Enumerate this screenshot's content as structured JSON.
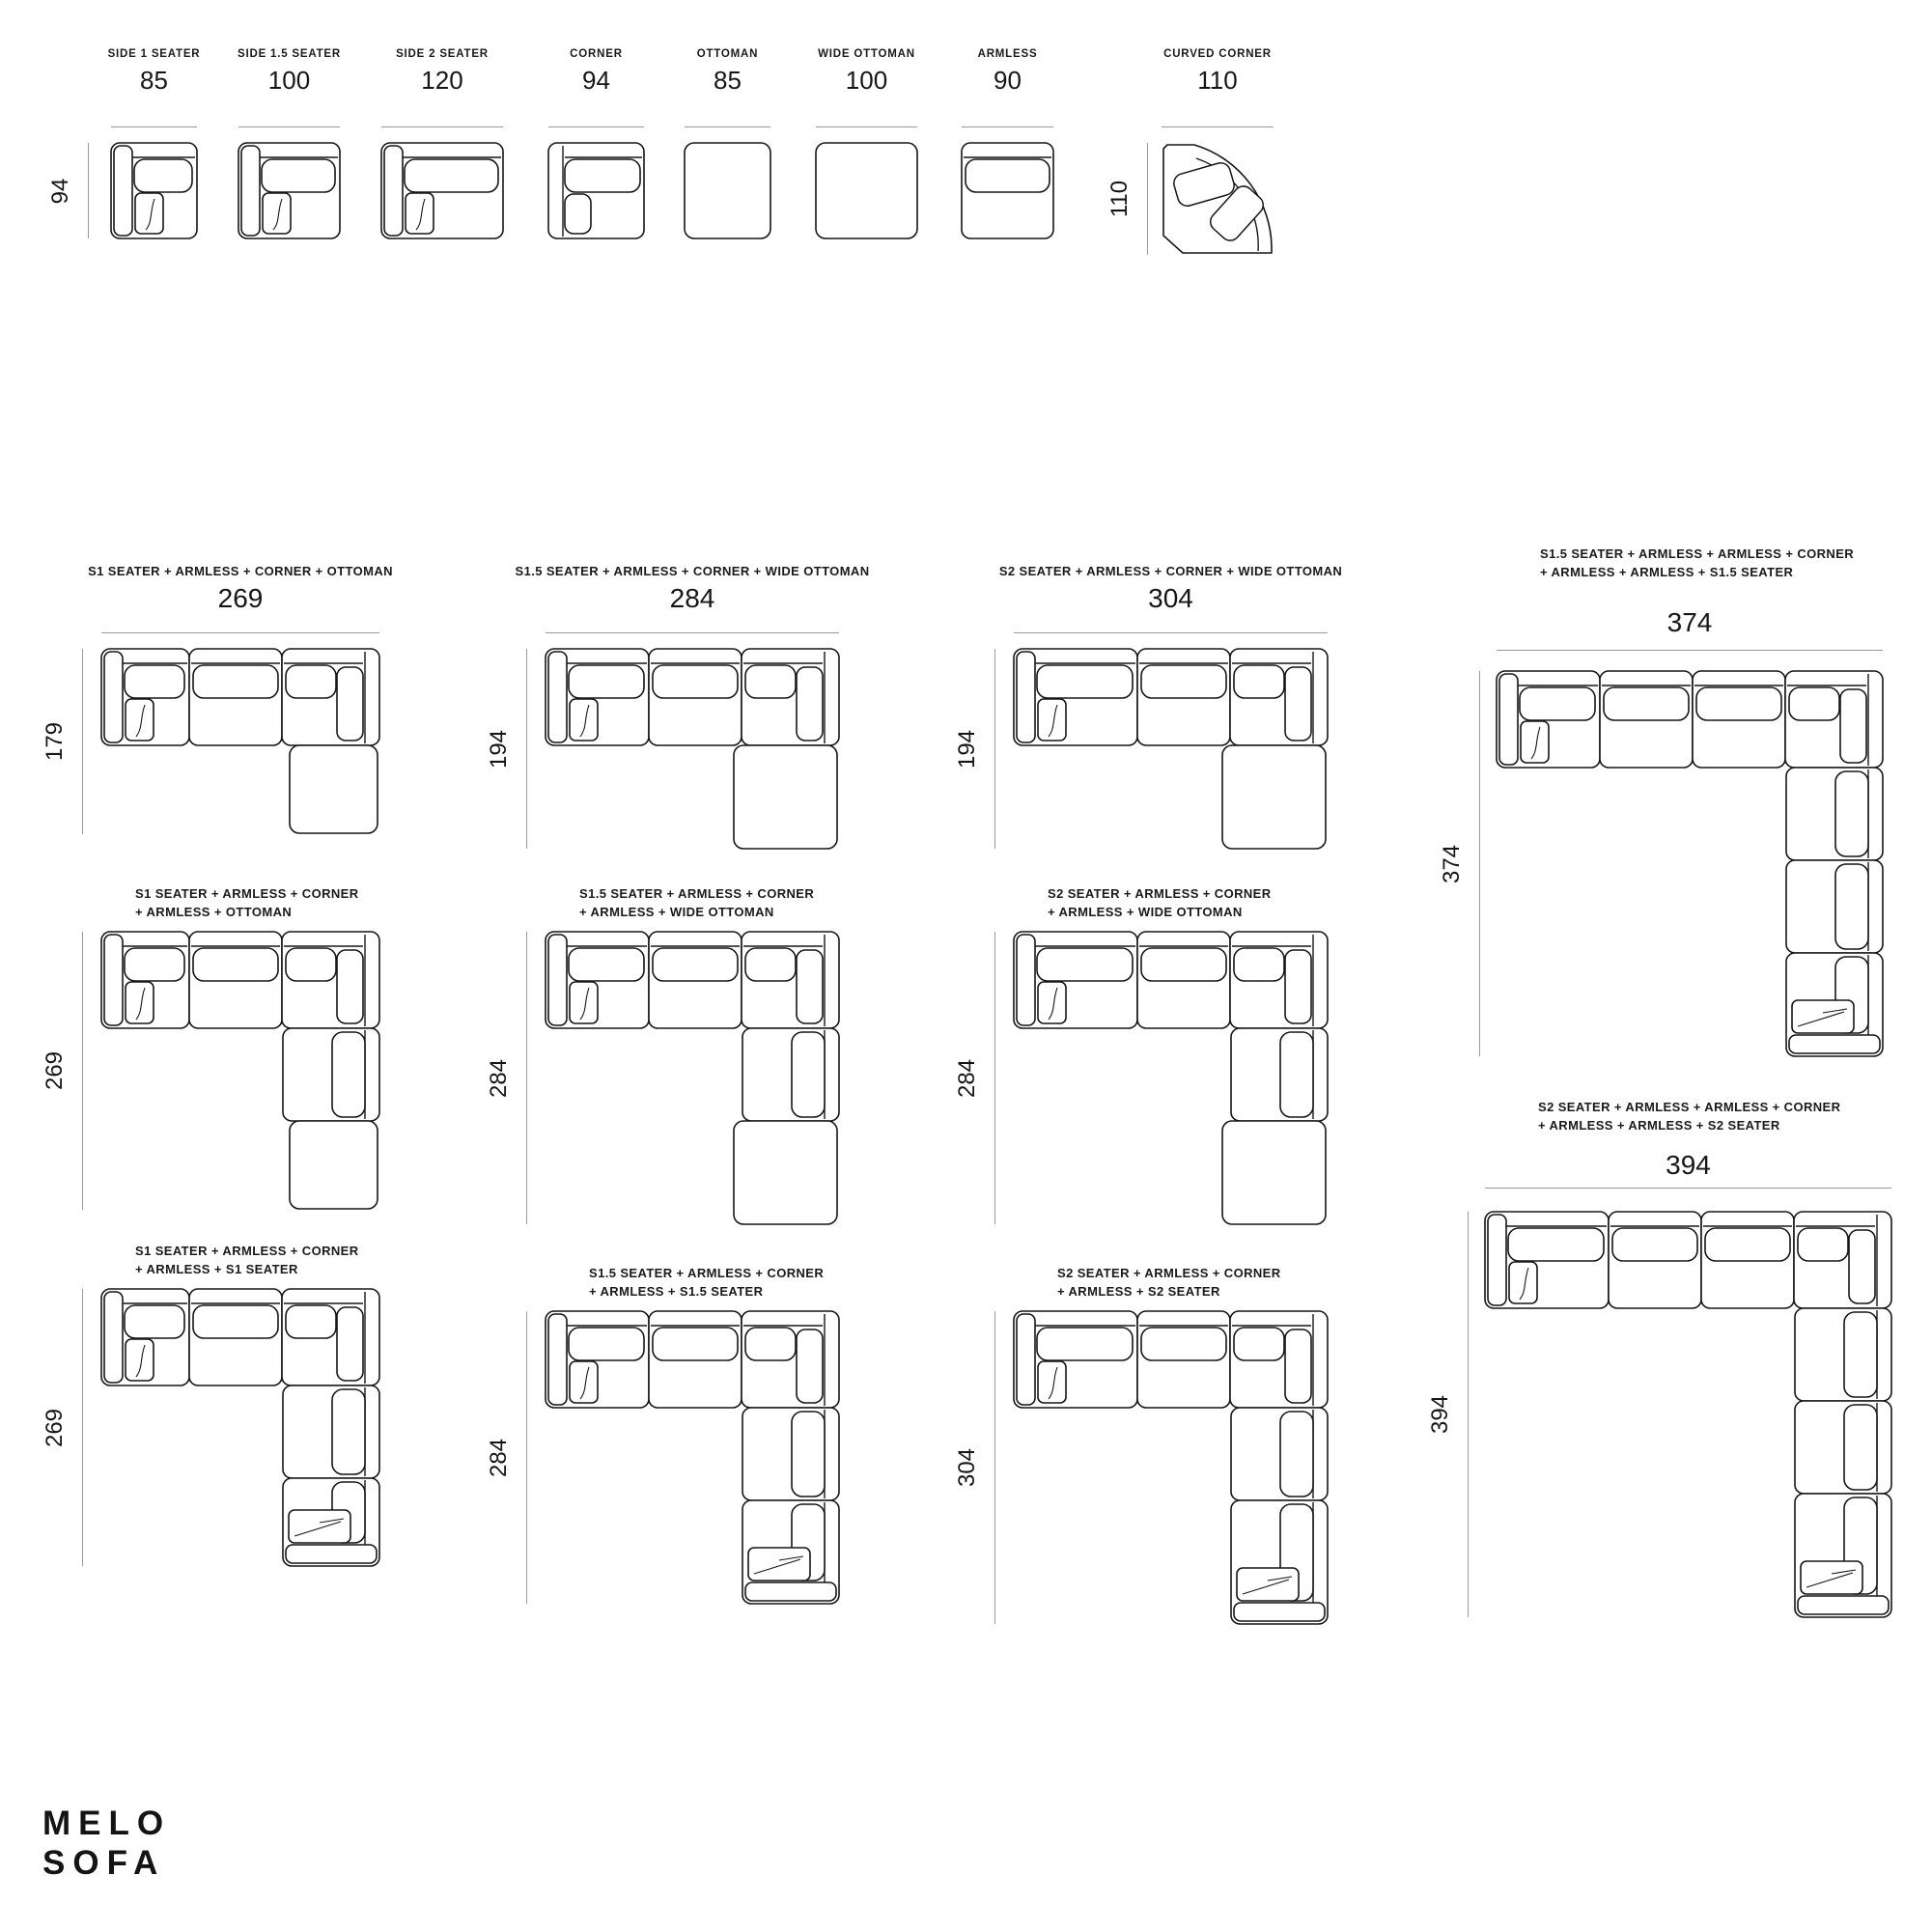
{
  "brand": {
    "line1": "MELO",
    "line2": "SOFA"
  },
  "module_widths_cm": {
    "side-1-seater": 85,
    "side-1.5-seater": 100,
    "side-2-seater": 120,
    "corner": 94,
    "ottoman": 85,
    "wide-ottoman": 100,
    "armless": 90,
    "curved-corner": 110
  },
  "module_depth_cm": 94,
  "modules": [
    {
      "name": "SIDE 1 SEATER",
      "width": "85",
      "depth": "94",
      "type": "side-seater"
    },
    {
      "name": "SIDE 1.5 SEATER",
      "width": "100",
      "type": "side-seater"
    },
    {
      "name": "SIDE 2 SEATER",
      "width": "120",
      "type": "side-seater"
    },
    {
      "name": "CORNER",
      "width": "94",
      "type": "corner"
    },
    {
      "name": "OTTOMAN",
      "width": "85",
      "type": "ottoman"
    },
    {
      "name": "WIDE OTTOMAN",
      "width": "100",
      "type": "ottoman"
    },
    {
      "name": "ARMLESS",
      "width": "90",
      "type": "armless"
    },
    {
      "name": "CURVED CORNER",
      "width": "110",
      "depth": "110",
      "type": "curved-corner"
    }
  ],
  "configs": [
    {
      "label_lines": [
        "S1 SEATER + ARMLESS + CORNER + OTTOMAN"
      ],
      "width": "269",
      "height": "179",
      "row_modules": [
        "side-1-seater",
        "armless",
        "corner"
      ],
      "column_modules": [
        "ottoman"
      ]
    },
    {
      "label_lines": [
        "S1.5 SEATER + ARMLESS + CORNER + WIDE OTTOMAN"
      ],
      "width": "284",
      "height": "194",
      "row_modules": [
        "side-1.5-seater",
        "armless",
        "corner"
      ],
      "column_modules": [
        "wide-ottoman"
      ]
    },
    {
      "label_lines": [
        "S2 SEATER + ARMLESS + CORNER + WIDE OTTOMAN"
      ],
      "width": "304",
      "height": "194",
      "row_modules": [
        "side-2-seater",
        "armless",
        "corner"
      ],
      "column_modules": [
        "wide-ottoman"
      ]
    },
    {
      "label_lines": [
        "S1.5 SEATER + ARMLESS + ARMLESS + CORNER",
        "+ ARMLESS + ARMLESS + S1.5 SEATER"
      ],
      "width": "374",
      "height": "374",
      "row_modules": [
        "side-1.5-seater",
        "armless",
        "armless",
        "corner"
      ],
      "column_modules": [
        "armless",
        "armless",
        "side-1.5-seater"
      ]
    },
    {
      "label_lines": [
        "S1 SEATER + ARMLESS + CORNER",
        "+ ARMLESS + OTTOMAN"
      ],
      "height": "269",
      "row_modules": [
        "side-1-seater",
        "armless",
        "corner"
      ],
      "column_modules": [
        "armless",
        "ottoman"
      ]
    },
    {
      "label_lines": [
        "S1.5 SEATER + ARMLESS + CORNER",
        "+ ARMLESS + WIDE OTTOMAN"
      ],
      "height": "284",
      "row_modules": [
        "side-1.5-seater",
        "armless",
        "corner"
      ],
      "column_modules": [
        "armless",
        "wide-ottoman"
      ]
    },
    {
      "label_lines": [
        "S2 SEATER + ARMLESS + CORNER",
        "+ ARMLESS + WIDE OTTOMAN"
      ],
      "height": "284",
      "row_modules": [
        "side-2-seater",
        "armless",
        "corner"
      ],
      "column_modules": [
        "armless",
        "wide-ottoman"
      ]
    },
    {
      "label_lines": [
        "S1 SEATER + ARMLESS + CORNER",
        "+ ARMLESS + S1 SEATER"
      ],
      "height": "269",
      "row_modules": [
        "side-1-seater",
        "armless",
        "corner"
      ],
      "column_modules": [
        "armless",
        "side-1-seater"
      ]
    },
    {
      "label_lines": [
        "S1.5 SEATER + ARMLESS + CORNER",
        "+ ARMLESS + S1.5 SEATER"
      ],
      "height": "284",
      "row_modules": [
        "side-1.5-seater",
        "armless",
        "corner"
      ],
      "column_modules": [
        "armless",
        "side-1.5-seater"
      ]
    },
    {
      "label_lines": [
        "S2 SEATER + ARMLESS + CORNER",
        "+ ARMLESS + S2 SEATER"
      ],
      "height": "304",
      "row_modules": [
        "side-2-seater",
        "armless",
        "corner"
      ],
      "column_modules": [
        "armless",
        "side-2-seater"
      ]
    },
    {
      "label_lines": [
        "S2 SEATER + ARMLESS + ARMLESS + CORNER",
        "+ ARMLESS + ARMLESS + S2 SEATER"
      ],
      "width": "394",
      "height": "394",
      "row_modules": [
        "side-2-seater",
        "armless",
        "armless",
        "corner"
      ],
      "column_modules": [
        "armless",
        "armless",
        "side-2-seater"
      ]
    }
  ]
}
